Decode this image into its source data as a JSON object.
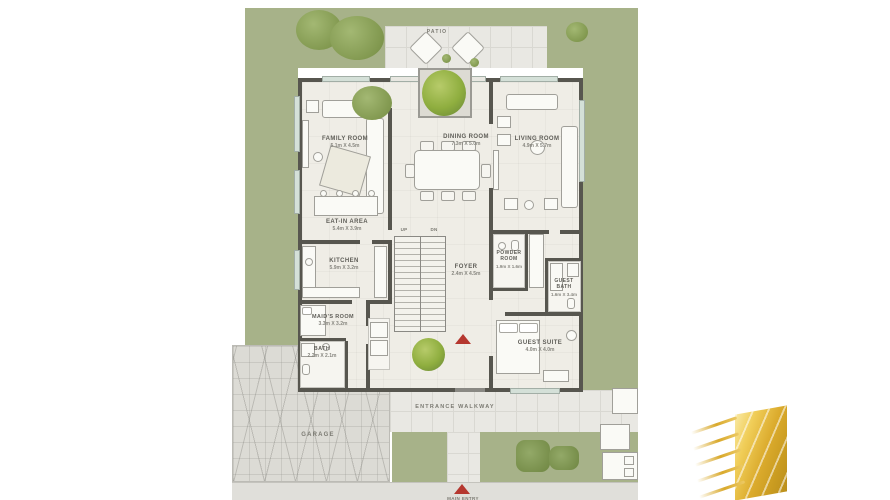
{
  "areas": {
    "patio": "PATIO",
    "walkway": "ENTRANCE WALKWAY",
    "garage": "GARAGE",
    "main_entry": "MAIN ENTRY"
  },
  "stairs": {
    "up": "UP",
    "dn": "DN"
  },
  "rooms": {
    "family": {
      "name": "FAMILY ROOM",
      "dims": "5.1m X 4.5m"
    },
    "dining": {
      "name": "DINING ROOM",
      "dims": "7.3m X 5.0m"
    },
    "living": {
      "name": "LIVING ROOM",
      "dims": "4.9m X 5.7m"
    },
    "eatin": {
      "name": "EAT-IN AREA",
      "dims": "5.4m X 3.9m"
    },
    "kitchen": {
      "name": "KITCHEN",
      "dims": "5.9m X 3.2m"
    },
    "foyer": {
      "name": "FOYER",
      "dims": "2.4m X 4.5m"
    },
    "powder": {
      "name": "POWDER ROOM",
      "dims": "1.9m X 1.6m"
    },
    "guest_bath": {
      "name": "GUEST BATH",
      "dims": "1.6m X 3.4m"
    },
    "maids": {
      "name": "MAID'S ROOM",
      "dims": "3.3m X 3.2m"
    },
    "bath": {
      "name": "BATH",
      "dims": "2.2m X 2.1m"
    },
    "guest_suite": {
      "name": "GUEST SUITE",
      "dims": "4.0m X 4.0m"
    }
  },
  "colors": {
    "lawn": "#a7b289",
    "bush": "#81984f",
    "wall": "#57564f",
    "floor": "#efede6",
    "tile": "#e9e8e3",
    "entry_marker_red": "#b5372f",
    "logo_gold": "#d9a92c"
  }
}
